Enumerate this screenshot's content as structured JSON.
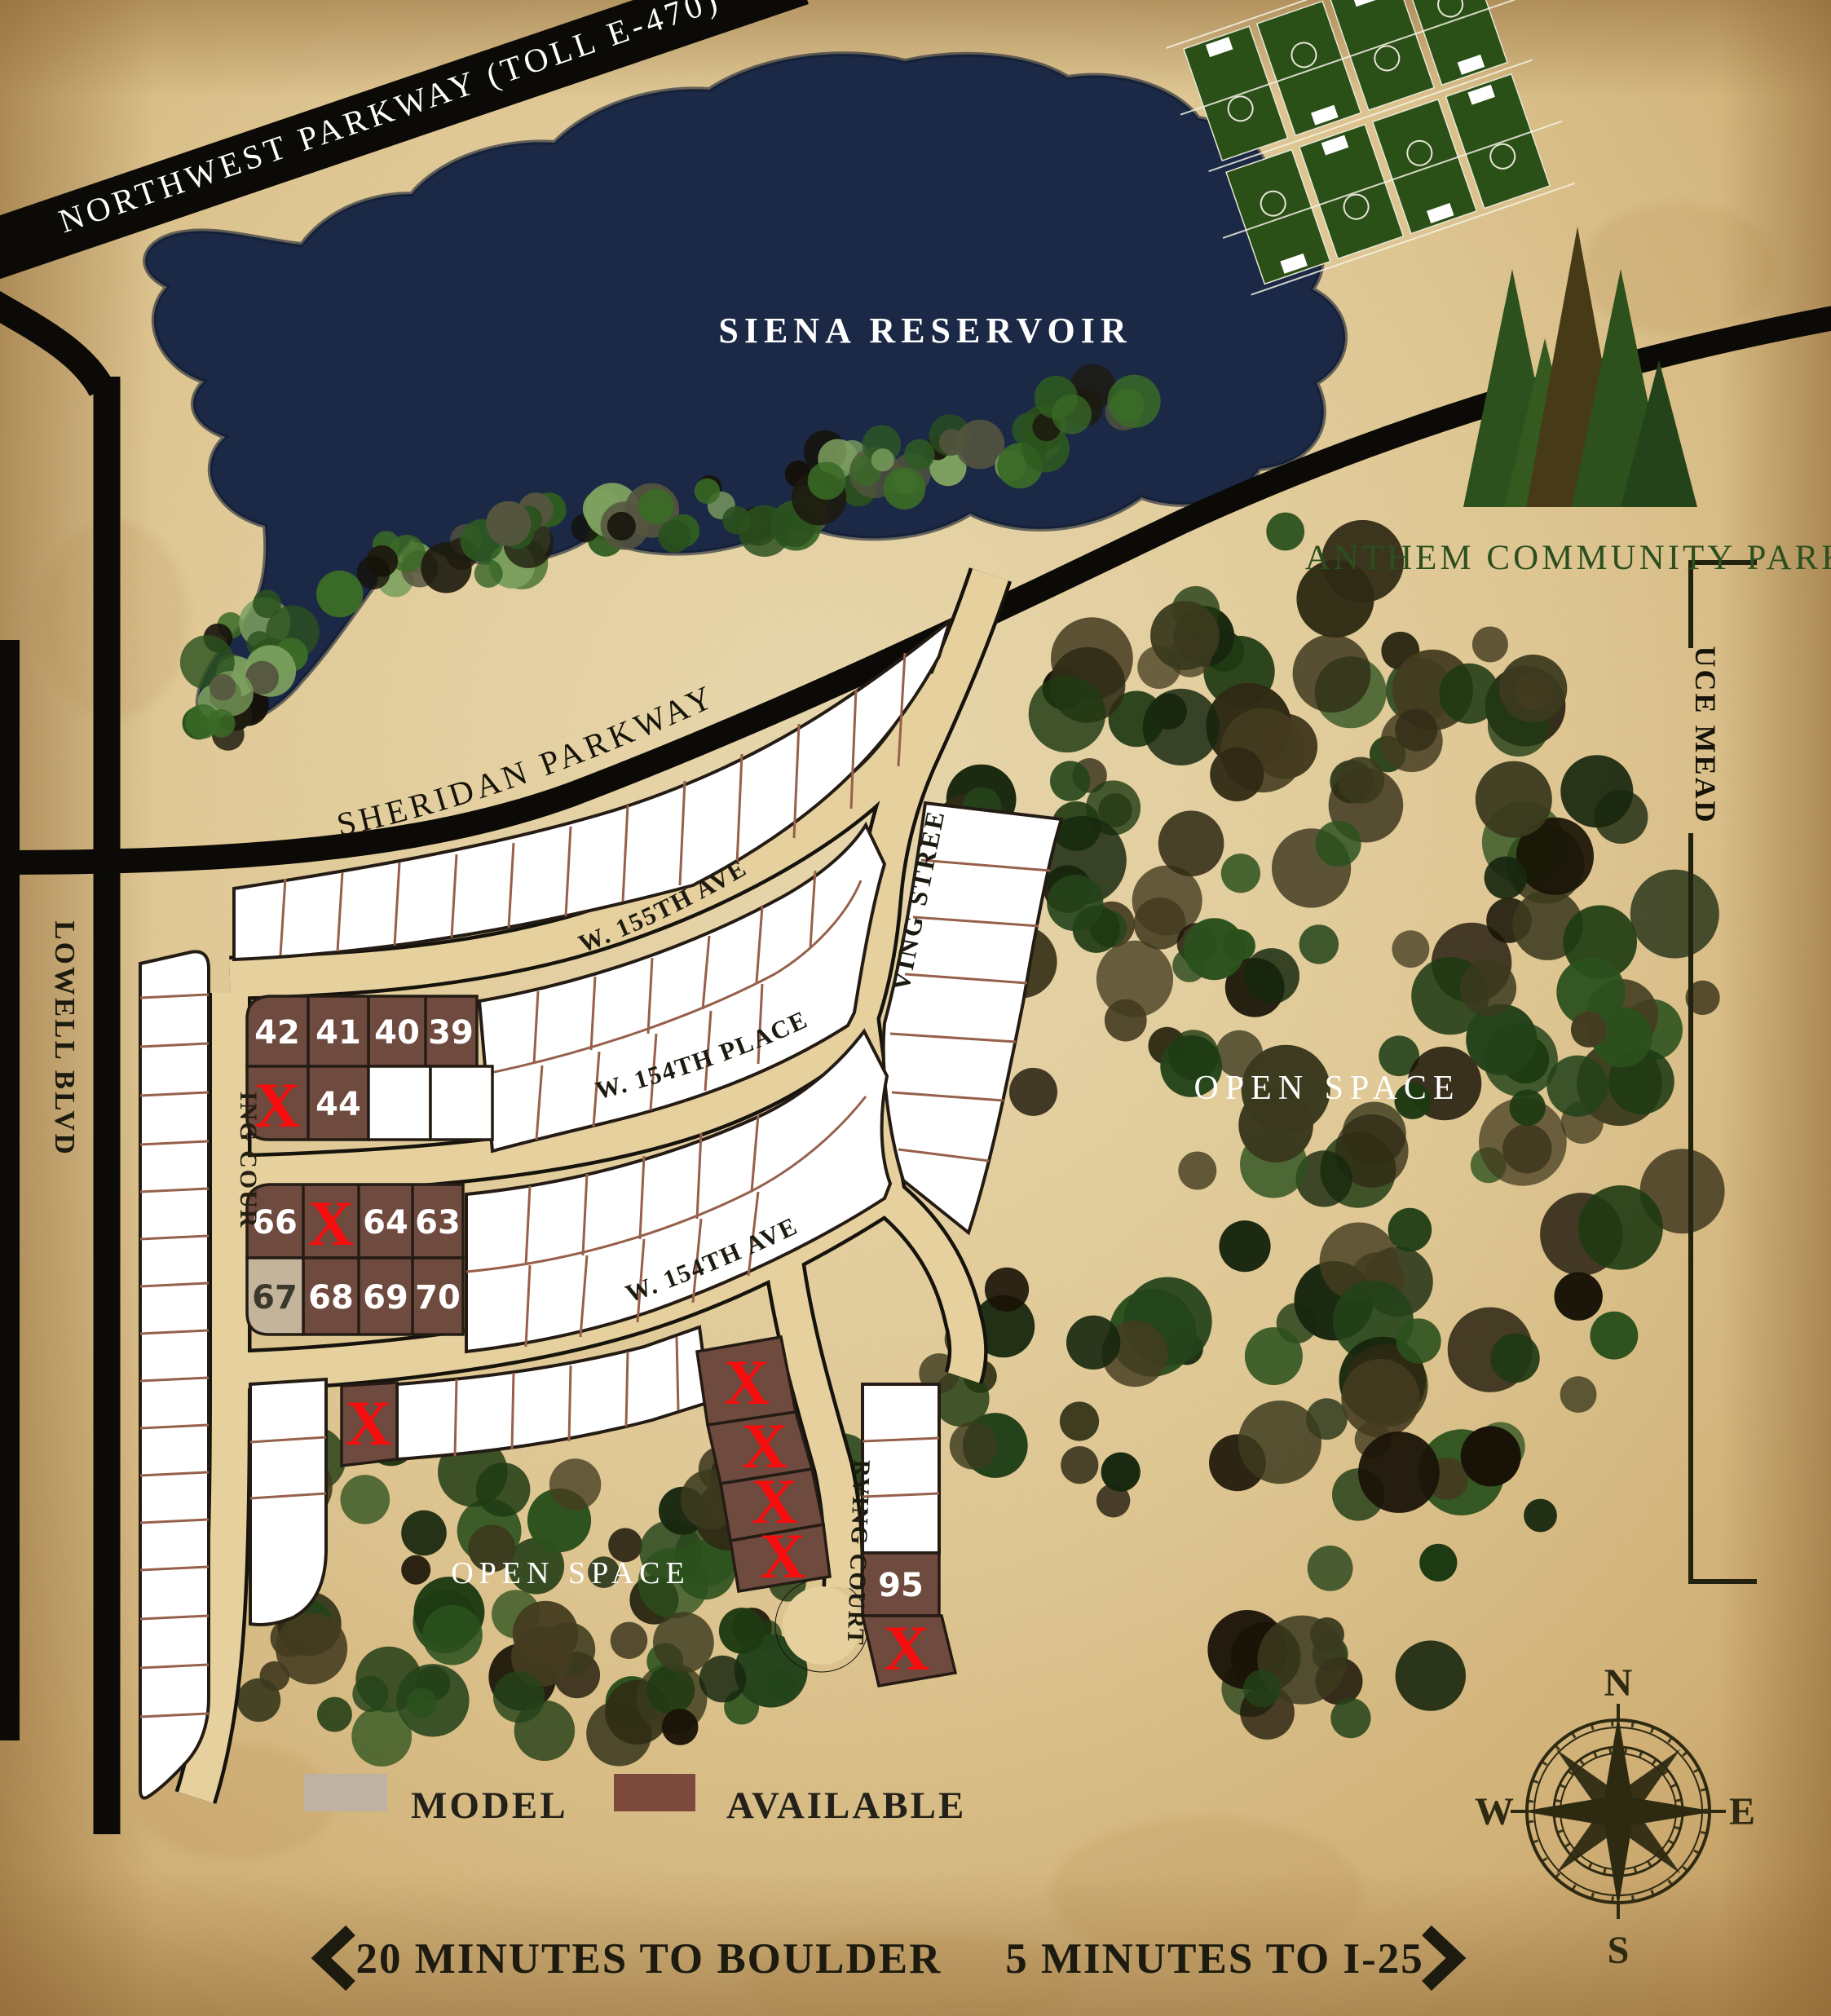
{
  "roads": {
    "northwest_parkway": "NORTHWEST PARKWAY (TOLL E-470)",
    "sheridan_parkway": "SHERIDAN PARKWAY",
    "lowell_blvd": "LOWELL BLVD",
    "king_court": "KING COURT",
    "w_155th_ave": "W. 155TH AVE",
    "w_154th_place": "W. 154TH PLACE",
    "w_154th_ave": "W. 154TH AVE",
    "irving_street": "IRVING STREET",
    "irving_court": "IRVING COURT"
  },
  "water": {
    "reservoir": "SIENA RESERVOIR"
  },
  "areas": {
    "park": "ANTHEM COMMUNITY PARK",
    "open_space": "OPEN SPACE",
    "spruce_meadows": "SPRUCE MEADOWS"
  },
  "legend": {
    "model": "MODEL",
    "available": "AVAILABLE"
  },
  "footer": {
    "boulder": "20 MINUTES TO BOULDER",
    "i25": "5 MINUTES TO I-25",
    "left_icon": "chevron-left",
    "right_icon": "chevron-right"
  },
  "compass": {
    "north": "N",
    "east": "E",
    "south": "S",
    "west": "W"
  },
  "lots": {
    "sold_marker": "X",
    "numbers": {
      "n42": "42",
      "n41": "41",
      "n40": "40",
      "n39": "39",
      "n44": "44",
      "n66": "66",
      "n64": "64",
      "n63": "63",
      "n67": "67",
      "n68": "68",
      "n69": "69",
      "n70": "70",
      "n95": "95"
    },
    "status_model_lot": "67",
    "sold_count": 8
  },
  "colors": {
    "parchment": "#e3cb97",
    "road": "#0b0a06",
    "street": "#e6d09e",
    "water": "#1b2946",
    "available": "#6f4a3e",
    "model": "#c3b49b",
    "sold_x": "#f70d0d",
    "forest": "#2b511d",
    "logo_green": "#2c511c",
    "label_dark": "#1d1b10",
    "label_light": "#ffffff"
  }
}
